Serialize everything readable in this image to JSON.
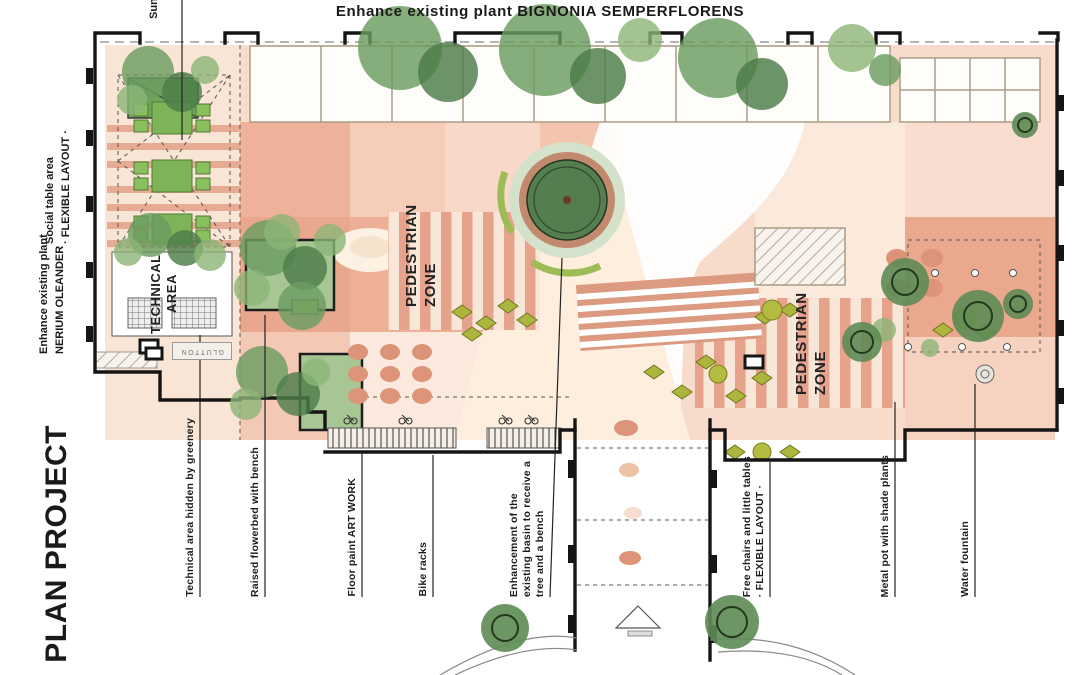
{
  "title": "Enhance existing plant BIGNONIA SEMPERFLORENS",
  "side": {
    "sunshade_partial": "Suns",
    "social_line1": "Social table area",
    "social_line2": "· FLEXIBLE LAYOUT ·",
    "plant_line1": "Enhance existing plant",
    "plant_line2": "NERIUM OLEANDER",
    "plan_title": "PLAN PROJECT"
  },
  "plan": {
    "technical_line1": "TECHNICAL",
    "technical_line2": "AREA",
    "pedestrian_left_line1": "PEDESTRIAN",
    "pedestrian_left_line2": "ZONE",
    "pedestrian_right_line1": "PEDESTRIAN",
    "pedestrian_right_line2": "ZONE",
    "glutton": "GLUTTON"
  },
  "annotations": [
    {
      "lines": [
        "Technical area hidden by greenery"
      ]
    },
    {
      "lines": [
        "Raised flowerbed with bench"
      ]
    },
    {
      "lines": [
        "Floor paint ART WORK"
      ]
    },
    {
      "lines": [
        "Bike racks"
      ]
    },
    {
      "lines": [
        "Enhancement of the",
        "existing basin to receive a",
        "tree and a bench"
      ]
    },
    {
      "lines": [
        "Free chairs and little tables",
        "· FLEXIBLE LAYOUT ·"
      ]
    },
    {
      "lines": [
        "Metal pot with shade plants"
      ]
    },
    {
      "lines": [
        "Water fountain"
      ]
    }
  ],
  "colors": {
    "salmon_dark": "#e49a82",
    "salmon_mid": "#eeb199",
    "salmon_light": "#f8ddd0",
    "cream": "#fcf1e2",
    "tree_green": "#4d7c49",
    "table_green": "#7db457",
    "olive": "#adb63c",
    "basin_green": "#547e4f",
    "basin_ring": "#c18a6f",
    "tan_line": "#ab9c85",
    "wall_black": "#151515"
  }
}
